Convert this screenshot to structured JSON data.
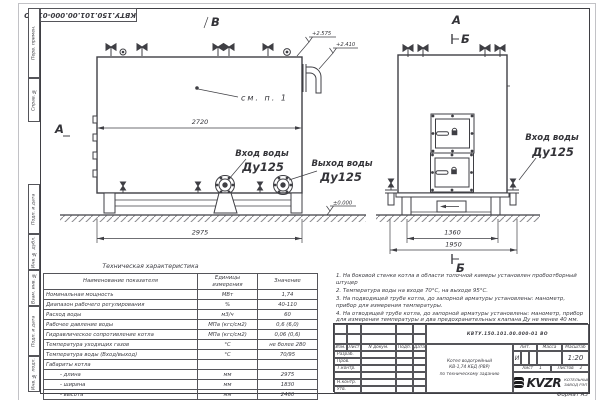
{
  "doc": {
    "number": "КВТУ.150.101.00.000-01 ВО",
    "format": "Формат  А3"
  },
  "frame_labels": {
    "perv": "Перв. примен.",
    "sprav": "Справ. №",
    "podp1": "Подп. и дата",
    "inv_dubl": "Инв. № дубл.",
    "vzam": "Взам. инв. №",
    "podp2": "Подп. и дата",
    "inv_podl": "Инв. № подл."
  },
  "views": {
    "side": {
      "label_top": "В",
      "label_left": "А",
      "dim_width": "2720",
      "dim_base": "2975",
      "elev_top": "+2.575",
      "elev_mid": "+2.410",
      "elev_zero": "±0.000",
      "note_ref": "см. п. 1",
      "inlet_line1": "Вход воды",
      "inlet_line2": "Ду125",
      "outlet_line1": "Выход воды",
      "outlet_line2": "Ду125"
    },
    "front": {
      "label_top": "А",
      "section_top": "Б",
      "section_bottom": "Б",
      "dim_legs": "1360",
      "dim_base": "1950",
      "inlet_line1": "Вход воды",
      "inlet_line2": "Ду125"
    }
  },
  "tech_table": {
    "title": "Техническая характеристика",
    "headers": [
      "Наименование показателя",
      "Единицы измерения",
      "Значение"
    ],
    "rows": [
      [
        "Номинальная мощность",
        "МВт",
        "1,74"
      ],
      [
        "Диапазон рабочего регулирования",
        "%",
        "40-110"
      ],
      [
        "Расход воды",
        "м3/ч",
        "60"
      ],
      [
        "Рабочее давление воды",
        "МПа (кгс/см2)",
        "0,6 (6,0)"
      ],
      [
        "Гидравлическое сопротивление котла",
        "МПа (кгс/см2)",
        "0,06 (0,6)"
      ],
      [
        "Температура уходящих газов",
        "°С",
        "не более 280"
      ],
      [
        "Температура воды (Вход/выход)",
        "°С",
        "70/95"
      ],
      [
        "Габариты котла",
        "",
        ""
      ],
      [
        "- длина",
        "мм",
        "2975"
      ],
      [
        "- ширина",
        "мм",
        "1830"
      ],
      [
        "- высота",
        "мм",
        "2460"
      ]
    ]
  },
  "notes": [
    "1. На боковой стенке котла в области топочной камеры установлен пробоотборный штуцер",
    "2. Температура воды на входе 70°С, на выходе 95°С.",
    "3. На подводящей трубе котла, до запорной арматуры установлены: манометр, прибор для измерения температуры.",
    "4. На отводящей трубе котла, до запорной арматуры установлены: манометр, прибор для измерения температуры и два предохранительных клапана Ду не менее 40 мм.",
    "5. Остальные технические требования по ОСТ 108.030.133-84."
  ],
  "title_block": {
    "header_cols": [
      "Изм.",
      "Лист",
      "N докум.",
      "Подп.",
      "Дата"
    ],
    "row_labels": [
      "Разраб.",
      "Пров.",
      "Т.контр.",
      "",
      "Н.контр.",
      "Утв."
    ],
    "title_lines": [
      "Котел водогрейный",
      "КВ-1,74 КБД (РВР)",
      "по техническому заданию"
    ],
    "lit_header": "Лит.",
    "mass_header": "Масса",
    "scale_header": "Масштаб",
    "lit_value": "И",
    "scale_value": "1:20",
    "sheet_label": "Лист",
    "sheet_no": "1",
    "sheets_label": "Листов",
    "sheets_no": "2",
    "logo_text": "KVZR",
    "logo_sub1": "КОТЕЛЬНЫЙ",
    "logo_sub2": "ЗАВОД РЭП"
  },
  "colors": {
    "line": "#3f3f44",
    "paper": "#ffffff",
    "hatch": "#8a8a8e"
  }
}
